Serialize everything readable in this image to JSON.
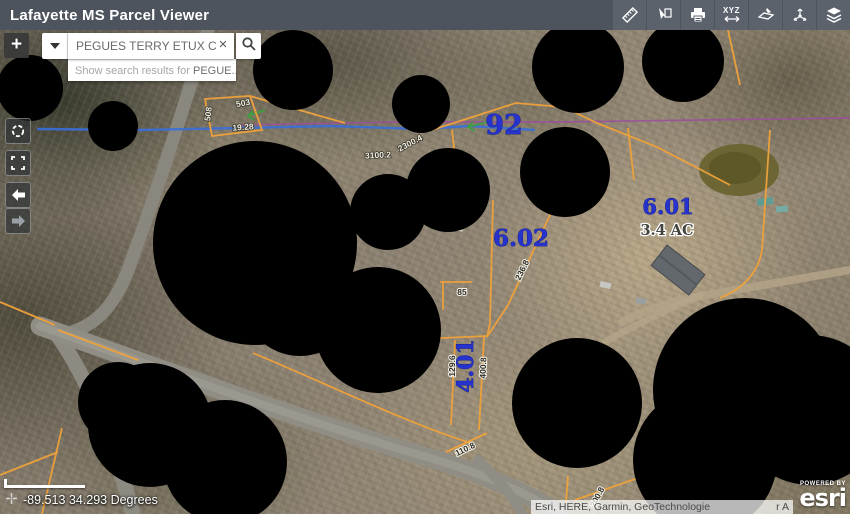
{
  "header": {
    "title": "Lafayette MS Parcel Viewer",
    "tools": [
      {
        "name": "measure",
        "label": ""
      },
      {
        "name": "select",
        "label": ""
      },
      {
        "name": "print",
        "label": ""
      },
      {
        "name": "xyz-coordinates",
        "label": "XYZ"
      },
      {
        "name": "draw",
        "label": ""
      },
      {
        "name": "share",
        "label": ""
      },
      {
        "name": "layers",
        "label": ""
      }
    ]
  },
  "search": {
    "value": "PEGUES TERRY ETUX CH",
    "clear_label": "×",
    "suggestion_prefix": "Show search results for ",
    "suggestion_query": "PEGUE..."
  },
  "map_controls": {
    "zoom_in": "+"
  },
  "map": {
    "parcel_labels": [
      {
        "text": "92"
      },
      {
        "text": "6.02"
      },
      {
        "text": "6.01"
      },
      {
        "text": "4.01"
      }
    ],
    "area_label": "3.4 AC",
    "dimension_labels": [
      "508",
      "503",
      "19.28",
      "2300.4",
      "3100.2",
      "173.8",
      "236.8",
      "85",
      "129.6",
      "400.8",
      "110.8",
      "200.8"
    ],
    "colors": {
      "parcel_line": "#f0a23a",
      "label_blue": "#2633cf",
      "stream_blue": "#3a6fd8",
      "boundary_purple": "#9b4f9e"
    }
  },
  "statusbar": {
    "coordinates": "-89.513 34.293 Degrees"
  },
  "attribution": {
    "text": "Esri, HERE, Garmin, GeoTechnologie",
    "fragment": "r A",
    "powered_by": "POWERED BY",
    "brand": "esri"
  }
}
